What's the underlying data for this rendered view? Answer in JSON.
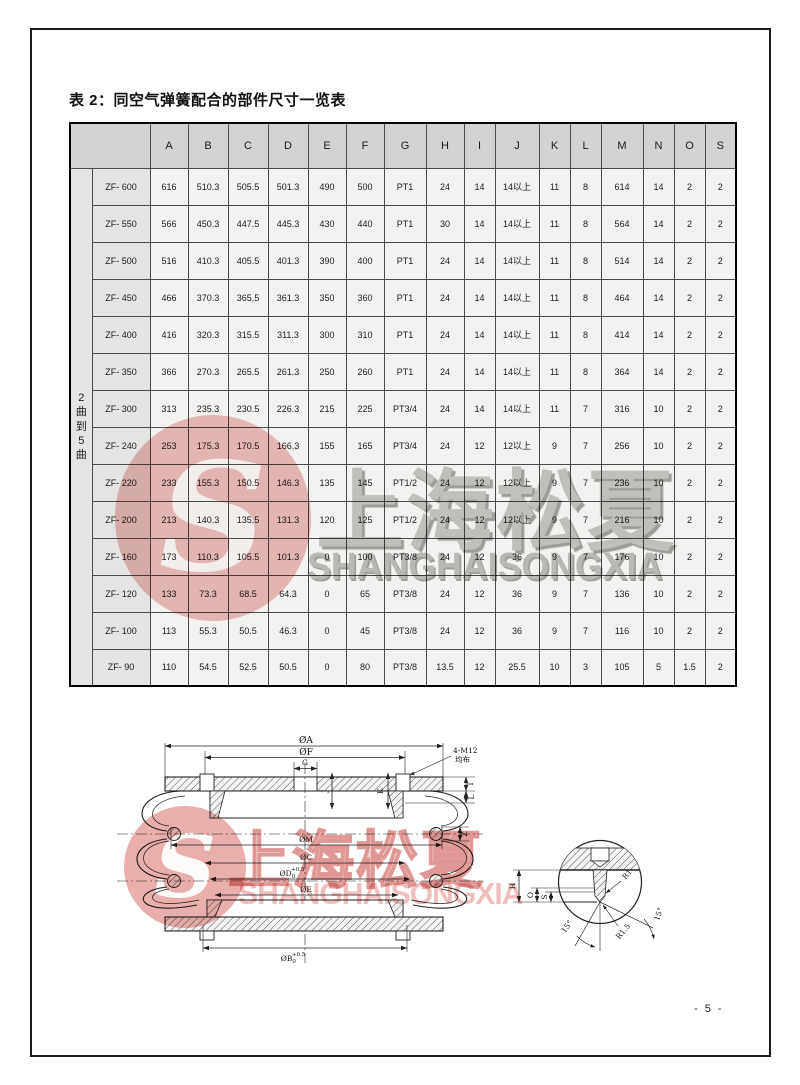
{
  "page": {
    "title": "表 2：同空气弹簧配合的部件尺寸一览表",
    "page_number": "- 5 -"
  },
  "table": {
    "group_label": "2曲到5曲",
    "columns": [
      "A",
      "B",
      "C",
      "D",
      "E",
      "F",
      "G",
      "H",
      "I",
      "J",
      "K",
      "L",
      "M",
      "N",
      "O",
      "S"
    ],
    "rows": [
      {
        "model": "ZF- 600",
        "values": [
          "616",
          "510.3",
          "505.5",
          "501.3",
          "490",
          "500",
          "PT1",
          "24",
          "14",
          "14以上",
          "11",
          "8",
          "614",
          "14",
          "2",
          "2"
        ]
      },
      {
        "model": "ZF- 550",
        "values": [
          "566",
          "450.3",
          "447.5",
          "445.3",
          "430",
          "440",
          "PT1",
          "30",
          "14",
          "14以上",
          "11",
          "8",
          "564",
          "14",
          "2",
          "2"
        ]
      },
      {
        "model": "ZF- 500",
        "values": [
          "516",
          "410.3",
          "405.5",
          "401.3",
          "390",
          "400",
          "PT1",
          "24",
          "14",
          "14以上",
          "11",
          "8",
          "514",
          "14",
          "2",
          "2"
        ]
      },
      {
        "model": "ZF- 450",
        "values": [
          "466",
          "370.3",
          "365.5",
          "361.3",
          "350",
          "360",
          "PT1",
          "24",
          "14",
          "14以上",
          "11",
          "8",
          "464",
          "14",
          "2",
          "2"
        ]
      },
      {
        "model": "ZF- 400",
        "values": [
          "416",
          "320.3",
          "315.5",
          "311.3",
          "300",
          "310",
          "PT1",
          "24",
          "14",
          "14以上",
          "11",
          "8",
          "414",
          "14",
          "2",
          "2"
        ]
      },
      {
        "model": "ZF- 350",
        "values": [
          "366",
          "270.3",
          "265.5",
          "261.3",
          "250",
          "260",
          "PT1",
          "24",
          "14",
          "14以上",
          "11",
          "8",
          "364",
          "14",
          "2",
          "2"
        ]
      },
      {
        "model": "ZF- 300",
        "values": [
          "313",
          "235.3",
          "230.5",
          "226.3",
          "215",
          "225",
          "PT3/4",
          "24",
          "14",
          "14以上",
          "11",
          "7",
          "316",
          "10",
          "2",
          "2"
        ]
      },
      {
        "model": "ZF- 240",
        "values": [
          "253",
          "175.3",
          "170.5",
          "166.3",
          "155",
          "165",
          "PT3/4",
          "24",
          "12",
          "12以上",
          "9",
          "7",
          "256",
          "10",
          "2",
          "2"
        ]
      },
      {
        "model": "ZF- 220",
        "values": [
          "233",
          "155.3",
          "150.5",
          "146.3",
          "135",
          "145",
          "PT1/2",
          "24",
          "12",
          "12以上",
          "9",
          "7",
          "236",
          "10",
          "2",
          "2"
        ]
      },
      {
        "model": "ZF- 200",
        "values": [
          "213",
          "140.3",
          "135.5",
          "131.3",
          "120",
          "125",
          "PT1/2",
          "24",
          "12",
          "12以上",
          "9",
          "7",
          "216",
          "10",
          "2",
          "2"
        ]
      },
      {
        "model": "ZF- 160",
        "values": [
          "173",
          "110.3",
          "105.5",
          "101.3",
          "0",
          "100",
          "PT3/8",
          "24",
          "12",
          "36",
          "9",
          "7",
          "176",
          "10",
          "2",
          "2"
        ]
      },
      {
        "model": "ZF- 120",
        "values": [
          "133",
          "73.3",
          "68.5",
          "64.3",
          "0",
          "65",
          "PT3/8",
          "24",
          "12",
          "36",
          "9",
          "7",
          "136",
          "10",
          "2",
          "2"
        ]
      },
      {
        "model": "ZF- 100",
        "values": [
          "113",
          "55.3",
          "50.5",
          "46.3",
          "0",
          "45",
          "PT3/8",
          "24",
          "12",
          "36",
          "9",
          "7",
          "116",
          "10",
          "2",
          "2"
        ]
      },
      {
        "model": "ZF- 90",
        "values": [
          "110",
          "54.5",
          "52.5",
          "50.5",
          "0",
          "80",
          "PT3/8",
          "13.5",
          "12",
          "25.5",
          "10",
          "3",
          "105",
          "5",
          "1.5",
          "2"
        ]
      }
    ]
  },
  "watermark": {
    "cn": "上海松夏",
    "en": "SHANGHAISONGXIA",
    "logo_letter": "S",
    "red": "#d65f5c",
    "gray": "#c9c9c7",
    "pink": "#e89a98"
  },
  "drawing": {
    "dia_a": "ØA",
    "dia_f": "ØF",
    "g": "G",
    "bolt_note_line1": "4-M12",
    "bolt_note_line2": "均布",
    "dia_m": "ØM",
    "dia_c": "ØC",
    "dia_d_base": "ØD",
    "dia_d_sub": "0",
    "dia_d_sup": "+0.5",
    "dia_e": "ØE",
    "dia_b_base": "ØB",
    "dia_b_sub": "0",
    "dia_b_sup": "+0.5",
    "i": "I",
    "l": "L",
    "z": "Z",
    "j": "J",
    "k": "K"
  },
  "detail": {
    "h": "H",
    "o": "O",
    "s": "S",
    "r1": "R1",
    "r15": "R1.5",
    "angle_left": "15°",
    "angle_right": "15°"
  }
}
